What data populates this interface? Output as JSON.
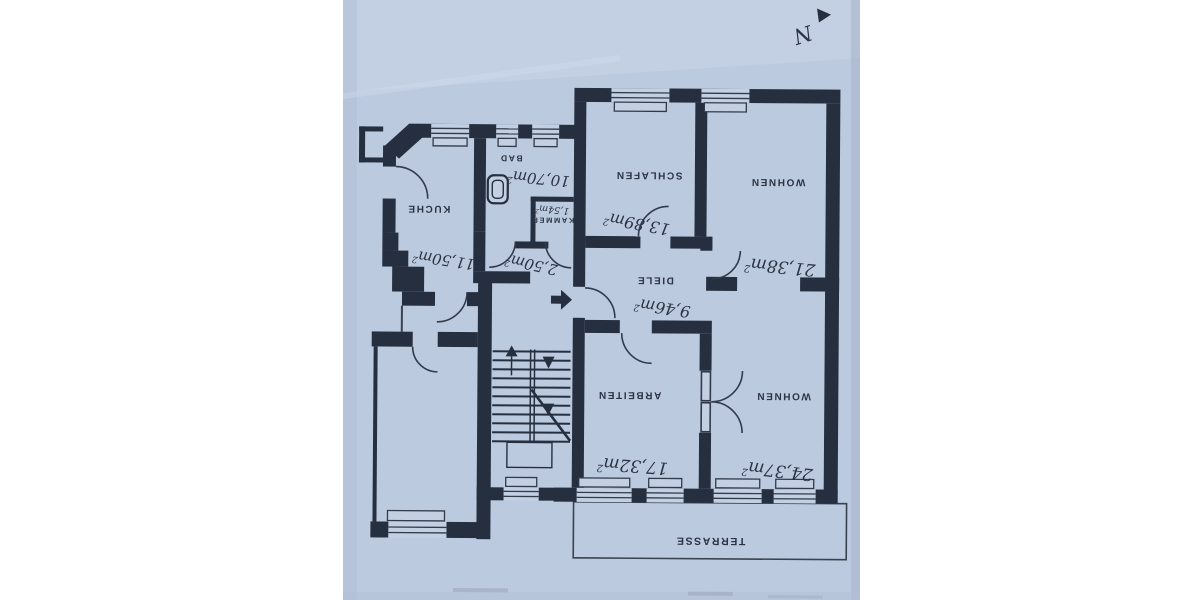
{
  "photo": {
    "paper_color": "#bccadf",
    "ink_color": "#262f3f",
    "background_color": "#ffffff",
    "orientation_note": "floor plan photographed upside down"
  },
  "compass": {
    "label": "N"
  },
  "rooms": {
    "kueche": {
      "label": "KUCHE",
      "area": "11,50m",
      "area_sup": "2"
    },
    "bad": {
      "label": "BAD",
      "area": "10,70m",
      "area_sup": "2"
    },
    "kammer": {
      "label": "KAMMER",
      "area": "1,54m",
      "area_sup": "2"
    },
    "schlafen": {
      "label": "SCHLAFEN",
      "area": "13,89m",
      "area_sup": "2"
    },
    "wohnen_nord": {
      "label": "WOHNEN",
      "area": "21,38m",
      "area_sup": "2"
    },
    "diele": {
      "label": "DIELE",
      "area": "9,46m",
      "area_sup": "2"
    },
    "flur": {
      "area": "2,50m",
      "area_sup": "2"
    },
    "arbeiten": {
      "label": "ARBEITEN",
      "area": "17,32m",
      "area_sup": "2"
    },
    "wohnen_sued": {
      "label": "WOHNEN",
      "area": "24,37m",
      "area_sup": "2"
    },
    "terrasse": {
      "label": "TERRASSE"
    }
  }
}
